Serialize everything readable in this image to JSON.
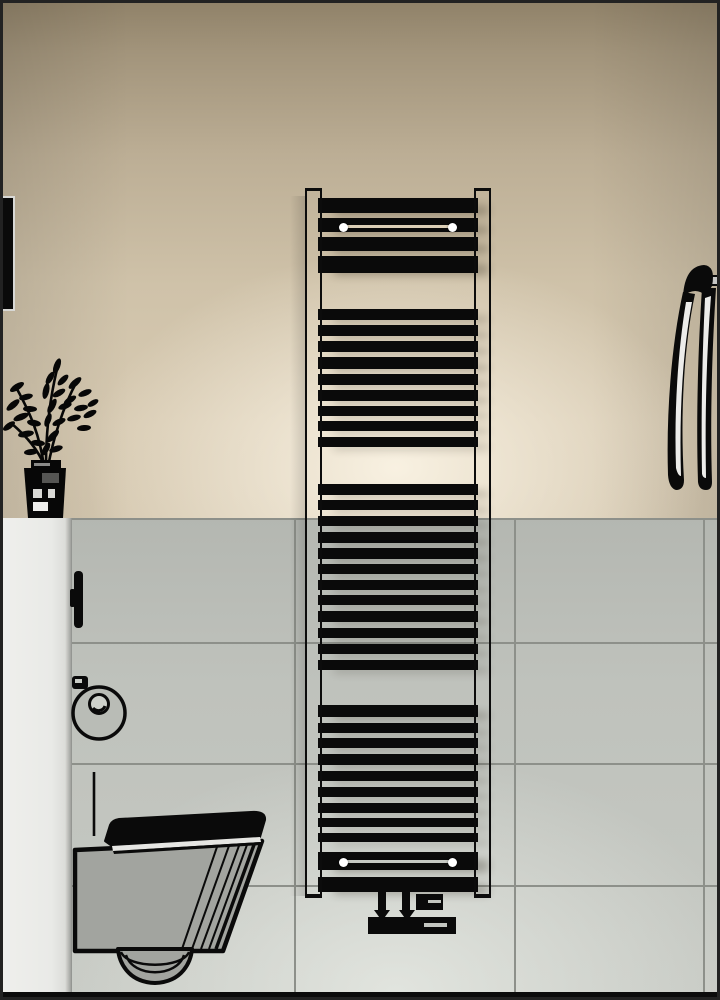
{
  "scene": {
    "title": "3D bathroom render with black towel radiator",
    "objects": [
      {
        "name": "towel-radiator",
        "description": "black multi-rung towel radiator with light chrome side rails, wall mounted"
      },
      {
        "name": "wall-hung-toilet",
        "description": "line-art wall-hung toilet with closed lid, side view, bottom left"
      },
      {
        "name": "potted-plant",
        "description": "black silhouette plant in dark pot standing on half-wall ledge, left"
      },
      {
        "name": "hanging-towel",
        "description": "towel hanging from a wall hook at the right edge"
      },
      {
        "name": "toilet-paper-holder",
        "description": "round toilet paper holder on tiled wall beside panel"
      },
      {
        "name": "panel-handle",
        "description": "small dark handle on edge of left panel"
      },
      {
        "name": "thermostatic-valve",
        "description": "black valve assembly below the radiator"
      },
      {
        "name": "wall-frame-sliver",
        "description": "dark frame edge visible at upper-left image border"
      }
    ],
    "colors": {
      "wall_upper_dark": "#8f8168",
      "wall_upper_light": "#e9ddc6",
      "tile_base": "#bfc2bc",
      "tile_glow": "#d6d9d3",
      "grout": "#8d908a",
      "panel": "#e9eae7",
      "radiator_rung": "#0a0a0a",
      "radiator_rail": "#f6f6f4",
      "mount_dot": "#ffffff",
      "mount_line_top": "#dbceb6",
      "mount_line_bottom": "#c6c9c3",
      "toilet_body": "#a2a49f",
      "towel_stripe": "#ececea",
      "hook": "#c6c6c4",
      "border": "#222222",
      "floor_strip": "#0b0b0b"
    },
    "radiator": {
      "rung_x": 318,
      "rung_width": 160,
      "rungs": [
        [
          198,
          15
        ],
        [
          218,
          14
        ],
        [
          237,
          14
        ],
        [
          256,
          17
        ],
        [
          309,
          11
        ],
        [
          325,
          11
        ],
        [
          341,
          11
        ],
        [
          357,
          12
        ],
        [
          374,
          11
        ],
        [
          390,
          11
        ],
        [
          406,
          10
        ],
        [
          421,
          10
        ],
        [
          437,
          10
        ],
        [
          484,
          11
        ],
        [
          500,
          10
        ],
        [
          516,
          10
        ],
        [
          532,
          11
        ],
        [
          548,
          11
        ],
        [
          564,
          10
        ],
        [
          580,
          10
        ],
        [
          595,
          10
        ],
        [
          611,
          11
        ],
        [
          628,
          10
        ],
        [
          644,
          10
        ],
        [
          660,
          10
        ],
        [
          705,
          12
        ],
        [
          723,
          10
        ],
        [
          738,
          10
        ],
        [
          754,
          11
        ],
        [
          771,
          10
        ],
        [
          787,
          10
        ],
        [
          803,
          10
        ],
        [
          818,
          9
        ],
        [
          833,
          9
        ],
        [
          852,
          18
        ],
        [
          877,
          15
        ]
      ],
      "mount_dot_xs": [
        339,
        448
      ],
      "mount_top_y": 223,
      "mount_bottom_y": 858,
      "dot_size": 9,
      "mount_line": {
        "x": 344,
        "width": 108,
        "top_y": 225,
        "bottom_y": 860
      }
    },
    "tiles": {
      "area_top": 518,
      "area_bottom": 992,
      "grout_vertical_x": [
        294,
        514,
        703
      ],
      "grout_horizontal_y": [
        518,
        642,
        763,
        885
      ]
    },
    "valve": {
      "pipes": [
        [
          378,
          889,
          8,
          24
        ],
        [
          402,
          889,
          8,
          24
        ]
      ],
      "arrows_cx": [
        382,
        407
      ],
      "arrows_y": 910,
      "block_right": [
        416,
        894,
        27,
        16
      ],
      "block_slit": [
        428,
        900,
        13,
        3
      ],
      "bar_low": [
        368,
        917,
        88,
        17
      ],
      "bar_slit": [
        424,
        923,
        23,
        4
      ]
    }
  }
}
